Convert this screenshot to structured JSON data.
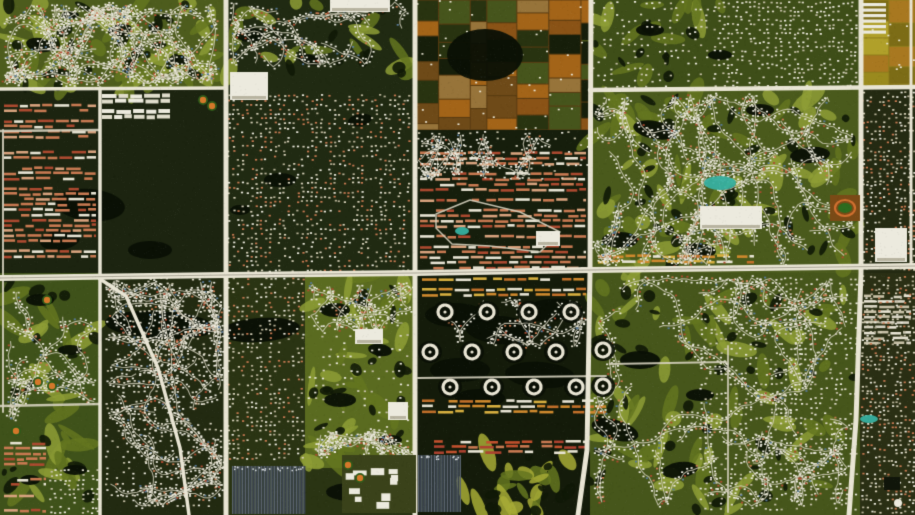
{
  "meta": {
    "width": 915,
    "height": 515,
    "alt": "Satellite aerial view of suburban planned communities with golf courses, lakes, farm fields and a grid of white arterial roads"
  },
  "scene": {
    "seed": 7,
    "palette": {
      "base": "#222a10",
      "road": "#e9e5d4",
      "road_stripe": "#a8a494",
      "minor_road": "#d6d2bf",
      "lake": "#0a1005",
      "tree_dark": "#101807",
      "golf_light": "#8e9e36",
      "golf_mid": "#647620",
      "golf_yellow": "#a7ab36",
      "stripe_a": "#39424c",
      "stripe_b": "#5a646e",
      "teal": "#37b0a0",
      "diamond_orange": "#d4782a",
      "white_box": "#eceade",
      "campus_base": "#3a421a",
      "house_colors": [
        "#eceade",
        "#dcd8c6",
        "#c97a52",
        "#ad4a30",
        "#5a7a9a"
      ],
      "speckle_styles": {
        "tan": [
          "#d8d2ba",
          "#eceade",
          "#b8b298",
          "#c97a52"
        ],
        "white": [
          "#eceade",
          "#dcd8c6",
          "#c4bfa6"
        ]
      },
      "row_styles": {
        "salmon": [
          "#c97a52",
          "#e8e4d4",
          "#ad4a30",
          "#c97a52",
          "#d9a37e"
        ],
        "red": [
          "#ad4230",
          "#c2512e",
          "#c97a52",
          "#e8e4d4"
        ],
        "orange": [
          "#d08a2e",
          "#d8b040",
          "#e8e4d4",
          "#c2702a"
        ],
        "white": [
          "#e8e4d4",
          "#d8d4c4",
          "#c9c2a8"
        ],
        "courtyard": [
          "#eceade",
          "#e0ddcc"
        ]
      },
      "farm_cells": [
        "#8a5316",
        "#a36418",
        "#6e4a18",
        "#283310",
        "#46551c",
        "#161e0a",
        "#97743a"
      ],
      "farm_yellow_cells": [
        "#9a8a1e",
        "#b0a02a",
        "#a87820",
        "#7c6c16",
        "#b89a28"
      ]
    },
    "regions": [
      {
        "x": 0,
        "y": 0,
        "w": 226,
        "h": 90,
        "fill": "#4d5c1d"
      },
      {
        "x": 0,
        "y": 88,
        "w": 226,
        "h": 187,
        "fill": "#1c2410"
      },
      {
        "x": 226,
        "y": 0,
        "w": 190,
        "h": 275,
        "fill": "#202a12"
      },
      {
        "x": 415,
        "y": 0,
        "w": 176,
        "h": 132,
        "fill": "#5a3c12"
      },
      {
        "x": 415,
        "y": 130,
        "w": 176,
        "h": 145,
        "fill": "#161e0c"
      },
      {
        "x": 590,
        "y": 0,
        "w": 272,
        "h": 92,
        "fill": "#3e4e18"
      },
      {
        "x": 590,
        "y": 90,
        "w": 272,
        "h": 183,
        "fill": "#4a5a1c"
      },
      {
        "x": 860,
        "y": 0,
        "w": 55,
        "h": 88,
        "fill": "#8f7d1d"
      },
      {
        "x": 860,
        "y": 88,
        "w": 55,
        "h": 185,
        "fill": "#242a12"
      },
      {
        "x": 0,
        "y": 273,
        "w": 102,
        "h": 242,
        "fill": "#3f521a"
      },
      {
        "x": 100,
        "y": 273,
        "w": 126,
        "h": 242,
        "fill": "#222a11"
      },
      {
        "x": 226,
        "y": 273,
        "w": 190,
        "h": 242,
        "fill": "#2a3413"
      },
      {
        "x": 305,
        "y": 273,
        "w": 110,
        "h": 195,
        "fill": "#5a6b20"
      },
      {
        "x": 415,
        "y": 273,
        "w": 176,
        "h": 242,
        "fill": "#141b0a"
      },
      {
        "x": 590,
        "y": 273,
        "w": 270,
        "h": 242,
        "fill": "#46561b"
      },
      {
        "x": 860,
        "y": 273,
        "w": 55,
        "h": 242,
        "fill": "#2a2f14"
      }
    ],
    "golf_zones": [
      {
        "x": 2,
        "y": 2,
        "w": 220,
        "h": 84,
        "n": 46
      },
      {
        "x": 228,
        "y": 2,
        "w": 184,
        "h": 72,
        "n": 16
      },
      {
        "x": 592,
        "y": 92,
        "w": 266,
        "h": 178,
        "n": 62
      },
      {
        "x": 592,
        "y": 276,
        "w": 264,
        "h": 236,
        "n": 62
      },
      {
        "x": 306,
        "y": 276,
        "w": 106,
        "h": 188,
        "n": 34
      },
      {
        "x": 2,
        "y": 276,
        "w": 98,
        "h": 236,
        "n": 26
      },
      {
        "x": 460,
        "y": 452,
        "w": 128,
        "h": 60,
        "n": 20,
        "yellow": true
      },
      {
        "x": 592,
        "y": 2,
        "w": 130,
        "h": 86,
        "n": 14
      }
    ],
    "farm_zones": [
      {
        "x": 415,
        "y": 0,
        "w": 175,
        "h": 130,
        "style": "brown",
        "specks": 46
      },
      {
        "x": 860,
        "y": 0,
        "w": 55,
        "h": 88,
        "style": "yellow",
        "specks": 10
      }
    ],
    "lakes": [
      [
        485,
        55,
        38,
        26,
        0
      ],
      [
        40,
        45,
        14,
        7,
        10
      ],
      [
        120,
        30,
        12,
        6,
        -8
      ],
      [
        180,
        60,
        10,
        5,
        0
      ],
      [
        70,
        15,
        9,
        4,
        0
      ],
      [
        90,
        205,
        35,
        16,
        5
      ],
      [
        60,
        240,
        20,
        10,
        -8
      ],
      [
        150,
        250,
        22,
        9,
        0
      ],
      [
        250,
        35,
        14,
        7,
        0
      ],
      [
        310,
        60,
        12,
        5,
        12
      ],
      [
        280,
        180,
        16,
        7,
        0
      ],
      [
        360,
        120,
        12,
        6,
        -10
      ],
      [
        240,
        210,
        10,
        5,
        0
      ],
      [
        160,
        325,
        55,
        14,
        3
      ],
      [
        260,
        330,
        40,
        12,
        -4
      ],
      [
        455,
        315,
        30,
        12,
        0
      ],
      [
        500,
        330,
        35,
        14,
        5
      ],
      [
        550,
        310,
        28,
        11,
        -6
      ],
      [
        460,
        370,
        30,
        12,
        0
      ],
      [
        540,
        375,
        35,
        13,
        4
      ],
      [
        480,
        398,
        25,
        9,
        0
      ],
      [
        655,
        130,
        22,
        9,
        10
      ],
      [
        810,
        155,
        20,
        8,
        -5
      ],
      [
        620,
        240,
        18,
        8,
        0
      ],
      [
        700,
        250,
        16,
        7,
        6
      ],
      [
        760,
        110,
        14,
        6,
        0
      ],
      [
        640,
        360,
        20,
        9,
        0
      ],
      [
        615,
        430,
        24,
        10,
        15
      ],
      [
        680,
        470,
        18,
        8,
        -8
      ],
      [
        700,
        395,
        14,
        6,
        0
      ],
      [
        335,
        310,
        15,
        7,
        0
      ],
      [
        380,
        350,
        12,
        6,
        8
      ],
      [
        340,
        400,
        16,
        7,
        0
      ],
      [
        390,
        440,
        12,
        5,
        0
      ],
      [
        650,
        30,
        14,
        6,
        0
      ],
      [
        720,
        55,
        12,
        5,
        0
      ],
      [
        40,
        300,
        14,
        6,
        0
      ],
      [
        70,
        350,
        12,
        5,
        0
      ],
      [
        30,
        480,
        10,
        5,
        0
      ],
      [
        75,
        470,
        12,
        5,
        0
      ],
      [
        350,
        492,
        24,
        9,
        0
      ]
    ],
    "stripe_zones": [
      {
        "x": 418,
        "y": 455,
        "w": 42,
        "h": 57
      },
      {
        "x": 232,
        "y": 466,
        "w": 73,
        "h": 48
      }
    ],
    "row_zones": [
      {
        "x": 2,
        "y": 92,
        "w": 96,
        "h": 180,
        "style": "salmon"
      },
      {
        "x": 418,
        "y": 150,
        "w": 170,
        "h": 122,
        "style": "salmon"
      },
      {
        "x": 432,
        "y": 428,
        "w": 156,
        "h": 25,
        "style": "red"
      },
      {
        "x": 420,
        "y": 276,
        "w": 168,
        "h": 26,
        "style": "orange"
      },
      {
        "x": 420,
        "y": 398,
        "w": 188,
        "h": 28,
        "style": "orange"
      },
      {
        "x": 596,
        "y": 253,
        "w": 160,
        "h": 13,
        "style": "orange"
      },
      {
        "x": 2,
        "y": 440,
        "w": 46,
        "h": 72,
        "style": "salmon"
      },
      {
        "x": 100,
        "y": 92,
        "w": 72,
        "h": 26,
        "style": "courtyard"
      },
      {
        "x": 862,
        "y": 293,
        "w": 51,
        "h": 60,
        "style": "white"
      }
    ],
    "speckle_zones": [
      {
        "x": 228,
        "y": 95,
        "w": 184,
        "h": 175,
        "step": 4.6,
        "fill": 0.5,
        "style": "tan"
      },
      {
        "x": 418,
        "y": 132,
        "w": 170,
        "h": 50,
        "step": 6.5,
        "fill": 0.4,
        "style": "white"
      },
      {
        "x": 862,
        "y": 92,
        "w": 51,
        "h": 178,
        "step": 4.2,
        "fill": 0.55,
        "style": "tan"
      },
      {
        "x": 862,
        "y": 276,
        "w": 51,
        "h": 236,
        "step": 4.2,
        "fill": 0.55,
        "style": "tan"
      },
      {
        "x": 228,
        "y": 278,
        "w": 76,
        "h": 182,
        "step": 4.6,
        "fill": 0.5,
        "style": "tan"
      },
      {
        "x": 714,
        "y": 2,
        "w": 144,
        "h": 84,
        "step": 4.4,
        "fill": 0.52,
        "style": "white"
      },
      {
        "x": 592,
        "y": 2,
        "w": 120,
        "h": 86,
        "step": 6.0,
        "fill": 0.38,
        "style": "white"
      },
      {
        "x": 700,
        "y": 278,
        "w": 156,
        "h": 232,
        "step": 5.0,
        "fill": 0.45,
        "style": "white"
      },
      {
        "x": 106,
        "y": 278,
        "w": 118,
        "h": 232,
        "step": 5.4,
        "fill": 0.4,
        "style": "white"
      },
      {
        "x": 50,
        "y": 470,
        "w": 48,
        "h": 42,
        "step": 4.6,
        "fill": 0.5,
        "style": "white"
      },
      {
        "x": 308,
        "y": 335,
        "w": 104,
        "h": 112,
        "step": 7.0,
        "fill": 0.3,
        "style": "white"
      }
    ],
    "string_zones": [
      {
        "x": 4,
        "y": 4,
        "w": 214,
        "h": 80,
        "n": 24
      },
      {
        "x": 594,
        "y": 94,
        "w": 260,
        "h": 172,
        "n": 30
      },
      {
        "x": 594,
        "y": 278,
        "w": 256,
        "h": 228,
        "n": 26
      },
      {
        "x": 108,
        "y": 280,
        "w": 114,
        "h": 226,
        "n": 22
      },
      {
        "x": 232,
        "y": 2,
        "w": 178,
        "h": 66,
        "n": 9
      },
      {
        "x": 8,
        "y": 290,
        "w": 88,
        "h": 130,
        "n": 6
      },
      {
        "x": 308,
        "y": 282,
        "w": 104,
        "h": 52,
        "n": 5
      },
      {
        "x": 318,
        "y": 430,
        "w": 94,
        "h": 28,
        "n": 4
      },
      {
        "x": 418,
        "y": 134,
        "w": 166,
        "h": 44,
        "n": 6
      },
      {
        "x": 418,
        "y": 300,
        "w": 170,
        "h": 46,
        "n": 5
      }
    ],
    "trefoils": {
      "centers": [
        [
          445,
          312
        ],
        [
          487,
          312
        ],
        [
          529,
          312
        ],
        [
          571,
          312
        ],
        [
          430,
          352
        ],
        [
          472,
          352
        ],
        [
          514,
          352
        ],
        [
          556,
          352
        ],
        [
          450,
          387
        ],
        [
          492,
          387
        ],
        [
          534,
          387
        ],
        [
          576,
          387
        ],
        [
          603,
          350
        ],
        [
          603,
          386
        ]
      ]
    },
    "minor_roads": [
      {
        "pts": [
          [
            418,
            378
          ],
          [
            606,
            376
          ]
        ],
        "w": 2
      },
      {
        "pts": [
          [
            610,
            364
          ],
          [
            726,
            362
          ]
        ],
        "w": 1.8
      },
      {
        "pts": [
          [
            728,
            346
          ],
          [
            728,
            512
          ]
        ],
        "w": 1.8
      },
      {
        "pts": [
          [
            3,
            130
          ],
          [
            3,
            412
          ]
        ],
        "w": 2
      },
      {
        "pts": [
          [
            436,
            214
          ],
          [
            470,
            200
          ],
          [
            520,
            212
          ],
          [
            560,
            232
          ],
          [
            540,
            252
          ],
          [
            490,
            246
          ],
          [
            452,
            244
          ],
          [
            436,
            228
          ],
          [
            436,
            214
          ]
        ],
        "w": 1.5
      },
      {
        "pts": [
          [
            0,
            131
          ],
          [
            98,
            130
          ]
        ],
        "w": 2.5
      },
      {
        "pts": [
          [
            0,
            406
          ],
          [
            100,
            404
          ]
        ],
        "w": 2.5
      }
    ],
    "arterials": [
      {
        "pts": [
          [
            100,
            88
          ],
          [
            100,
            515
          ]
        ],
        "w": 3.5
      },
      {
        "pts": [
          [
            911,
            0
          ],
          [
            911,
            268
          ]
        ],
        "w": 3
      },
      {
        "pts": [
          [
            0,
            89
          ],
          [
            226,
            88
          ]
        ],
        "w": 3.5
      },
      {
        "pts": [
          [
            590,
            90
          ],
          [
            915,
            87
          ]
        ],
        "w": 4.5
      },
      {
        "pts": [
          [
            100,
            279
          ],
          [
            126,
            296
          ],
          [
            158,
            368
          ],
          [
            180,
            448
          ],
          [
            189,
            515
          ]
        ],
        "w": 3.5
      },
      {
        "pts": [
          [
            226,
            0
          ],
          [
            226,
            515
          ]
        ],
        "w": 5
      },
      {
        "pts": [
          [
            415,
            0
          ],
          [
            415,
            515
          ]
        ],
        "w": 5
      },
      {
        "pts": [
          [
            591,
            0
          ],
          [
            590,
            273
          ],
          [
            587,
            450
          ],
          [
            578,
            515
          ]
        ],
        "w": 5
      },
      {
        "pts": [
          [
            861,
            0
          ],
          [
            861,
            273
          ],
          [
            856,
            420
          ],
          [
            849,
            515
          ]
        ],
        "w": 5
      },
      {
        "pts": [
          [
            0,
            278
          ],
          [
            226,
            275
          ],
          [
            415,
            273
          ],
          [
            590,
            270
          ],
          [
            915,
            266
          ]
        ],
        "w": 6,
        "stripe": true
      }
    ],
    "landmarks": {
      "white_boxes": [
        [
          230,
          72,
          38,
          28
        ],
        [
          700,
          206,
          62,
          23
        ],
        [
          875,
          228,
          32,
          34
        ],
        [
          536,
          231,
          24,
          15
        ],
        [
          355,
          329,
          28,
          15
        ],
        [
          388,
          402,
          20,
          18
        ],
        [
          330,
          0,
          60,
          12
        ]
      ],
      "greenhouse_bars": {
        "x": 862,
        "y": 3,
        "w": 24,
        "n": 6,
        "step": 5.5
      },
      "track": {
        "x": 830,
        "y": 195,
        "w": 30,
        "h": 26
      },
      "campus": {
        "x": 342,
        "y": 455,
        "w": 74,
        "h": 58,
        "buildings": 10
      },
      "diamonds": [
        [
          203,
          100
        ],
        [
          212,
          106
        ],
        [
          38,
          382
        ],
        [
          52,
          386
        ],
        [
          16,
          431
        ],
        [
          348,
          465
        ],
        [
          360,
          478
        ],
        [
          47,
          300
        ]
      ],
      "pools": [
        [
          720,
          183,
          16,
          7
        ],
        [
          462,
          231,
          7,
          4
        ],
        [
          869,
          419,
          9,
          4
        ]
      ],
      "tank": [
        898,
        503,
        4
      ],
      "dark_rects": [
        [
          884,
          477,
          16,
          13
        ]
      ]
    },
    "noise": {
      "count": 22000,
      "alpha": 0.05
    }
  }
}
